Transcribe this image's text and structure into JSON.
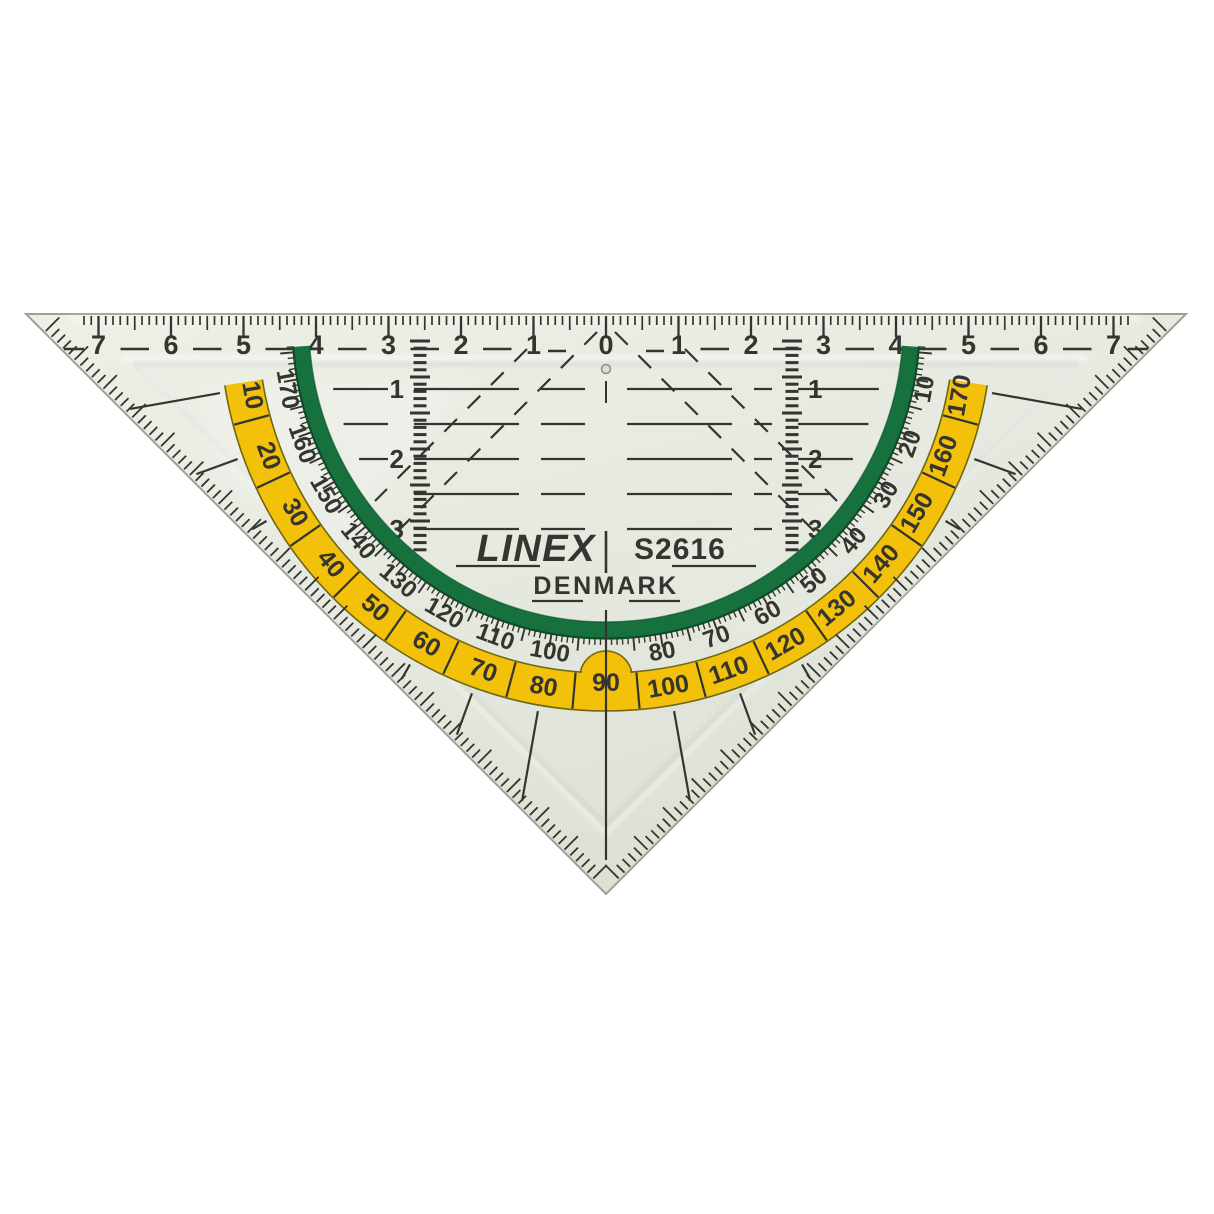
{
  "scene": {
    "background": "#ffffff",
    "description": "Transparent plastic geometry set square with protractor"
  },
  "brand": {
    "name": "LINEX",
    "model": "S2616",
    "country": "DENMARK"
  },
  "colors": {
    "body": "#e8eae2",
    "body_light": "#eff1e9",
    "body_dark": "#dde1d5",
    "body_edge": "#9aa295",
    "markings": "#33352e",
    "yellow_band": "#f3c00a",
    "yellow_edge": "#6f6713",
    "green_band": "#17713d",
    "green_edge": "#0a4f29",
    "hole_fill": "#d9dcd3",
    "hole_edge": "#8a8f85"
  },
  "ruler": {
    "numbers": [
      "7",
      "6",
      "5",
      "4",
      "3",
      "2",
      "1",
      "0",
      "1",
      "2",
      "3",
      "4",
      "5",
      "6",
      "7"
    ]
  },
  "protractor": {
    "outer_scale_labels": [
      10,
      20,
      30,
      40,
      50,
      60,
      70,
      80,
      90,
      100,
      110,
      120,
      130,
      140,
      150,
      160,
      170
    ],
    "inner_scale_labels": [
      170,
      160,
      150,
      140,
      130,
      120,
      110,
      100,
      80,
      70,
      60,
      50,
      40,
      30,
      20,
      10
    ]
  },
  "side_scales": {
    "labels": [
      "1",
      "2",
      "3"
    ]
  }
}
